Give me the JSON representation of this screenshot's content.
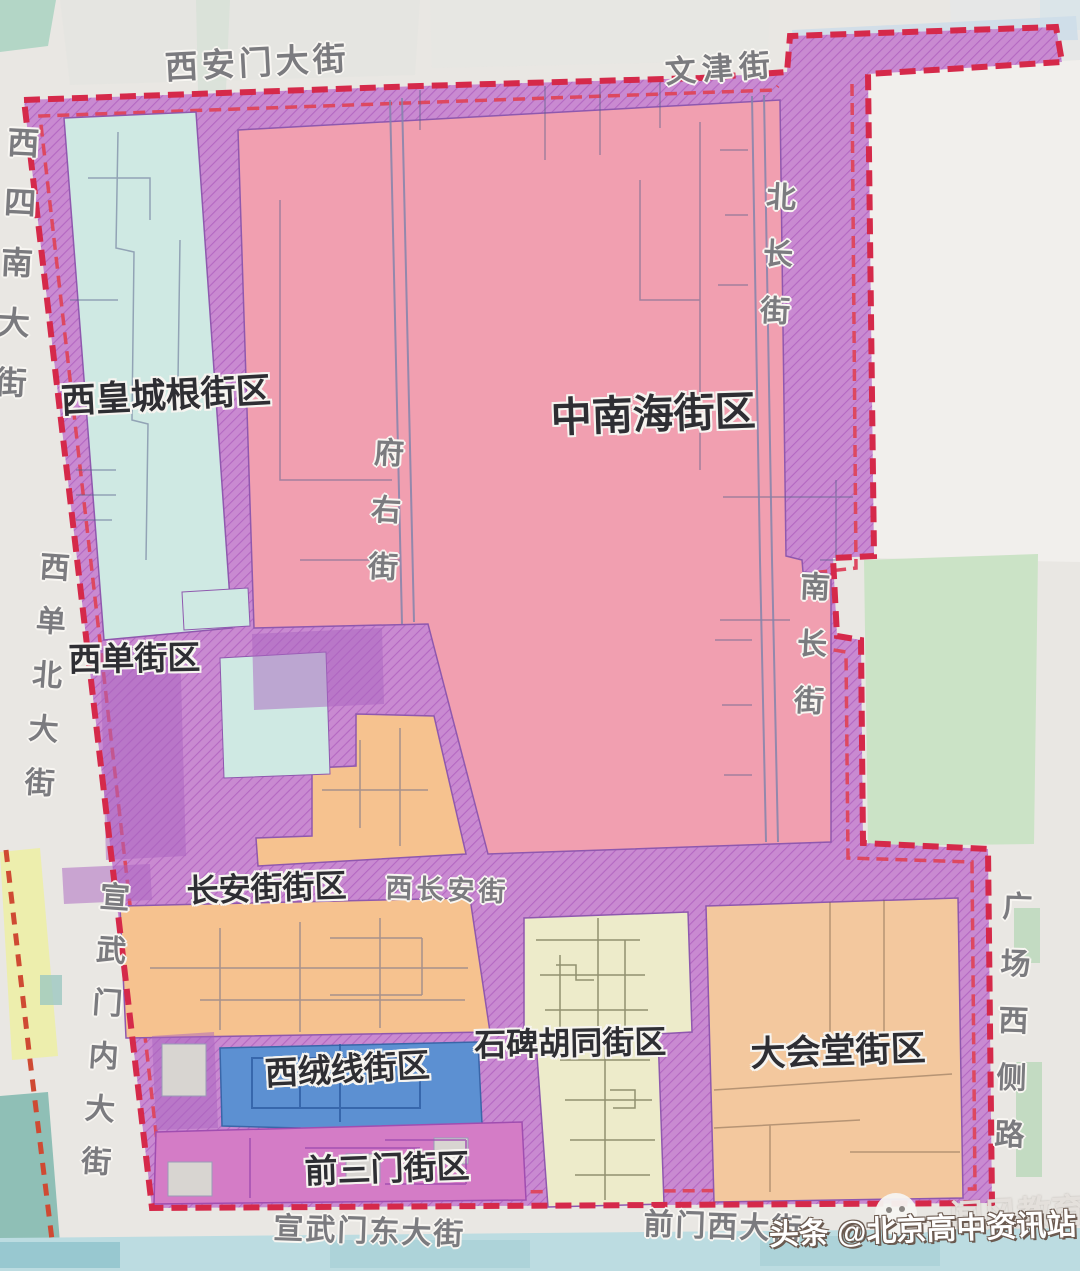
{
  "districts": [
    {
      "label": "西皇城根街区"
    },
    {
      "label": "中南海街区"
    },
    {
      "label": "西单街区"
    },
    {
      "label": "长安街街区"
    },
    {
      "label": "西绒线街区"
    },
    {
      "label": "石碑胡同街区"
    },
    {
      "label": "大会堂街区"
    },
    {
      "label": "前三门街区"
    }
  ],
  "streets": {
    "xianmen": "西安门大街",
    "wenjin": "文津街",
    "xichangan": "西长安街",
    "xuanwudong": "宣武门东大街",
    "qianmenxi": "前门西大街",
    "xisinan": "西四南大街",
    "beichang": "北长街",
    "nanchang": "南长街",
    "fuyou": "府右街",
    "xidanbei": "西单北大街",
    "xuanwunei": "宣武门内大街",
    "guangchangxice": "广场西侧路"
  },
  "watermark": {
    "source": "头条",
    "handle": "@北京高中资讯站",
    "brand": "闻风教育"
  },
  "colors": {
    "boundary_red": "#d5294a",
    "band_purple": "#c98ad1",
    "zhongnanhai_pink": "#f19fb0",
    "xihuangchenggen_cyan": "#cfe9e3",
    "changanjie_orange": "#f6c28f",
    "shibeihutong_cream": "#edebca",
    "dahuitang_orange": "#f3c89e",
    "xirongxian_blue": "#5c90d2",
    "qiansanmen_magenta": "#d47cc6",
    "park_green": "#cbe3c6",
    "background": "#e9e7e3"
  }
}
